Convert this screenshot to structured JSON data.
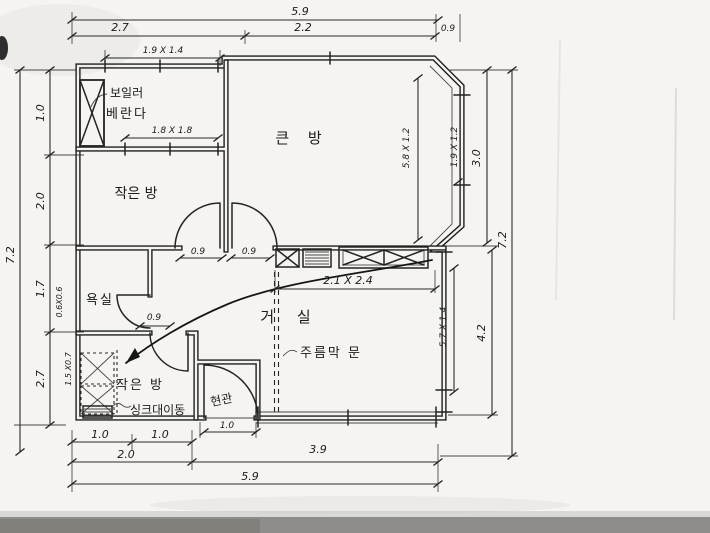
{
  "rooms": {
    "big_room": "큰 방",
    "small_room": "작은 방",
    "veranda": "베란다",
    "boiler": "보일러",
    "bathroom": "욕실",
    "utility_room": "작은 방",
    "entrance": "현관",
    "living_room": "거 실"
  },
  "notes": {
    "accordion_door": "주름막 문",
    "sink_move": "싱크대이동"
  },
  "dims": {
    "top_total": "5.9",
    "top_seg1": "2.7",
    "top_seg2": "2.2",
    "top_corner": "0.9",
    "veranda_window": "1.9 X 1.4",
    "small_room_window": "1.8 X 1.8",
    "left_total": "7.2",
    "left_seg1": "1.0",
    "left_seg2": "2.0",
    "left_seg3": "1.7",
    "left_seg4": "2.7",
    "left_note1": "0.6X0.6",
    "left_note2": "1.5 X0.7",
    "right_top": "3.0",
    "right_total": "7.2",
    "right_bottom": "4.2",
    "bay_inner": "5.8 X 1.2",
    "bay_window": "1.9 X 1.2",
    "living_window": "5.7 X 1.4",
    "closet": "2.1 X 2.4",
    "door_small": "0.9",
    "door_big": "0.9",
    "door_bath": "0.9",
    "bottom_seg1a": "1.0",
    "bottom_seg1b": "1.0",
    "entrance_door": "1.0",
    "bottom_left": "2.0",
    "bottom_right": "3.9",
    "bottom_total": "5.9"
  }
}
